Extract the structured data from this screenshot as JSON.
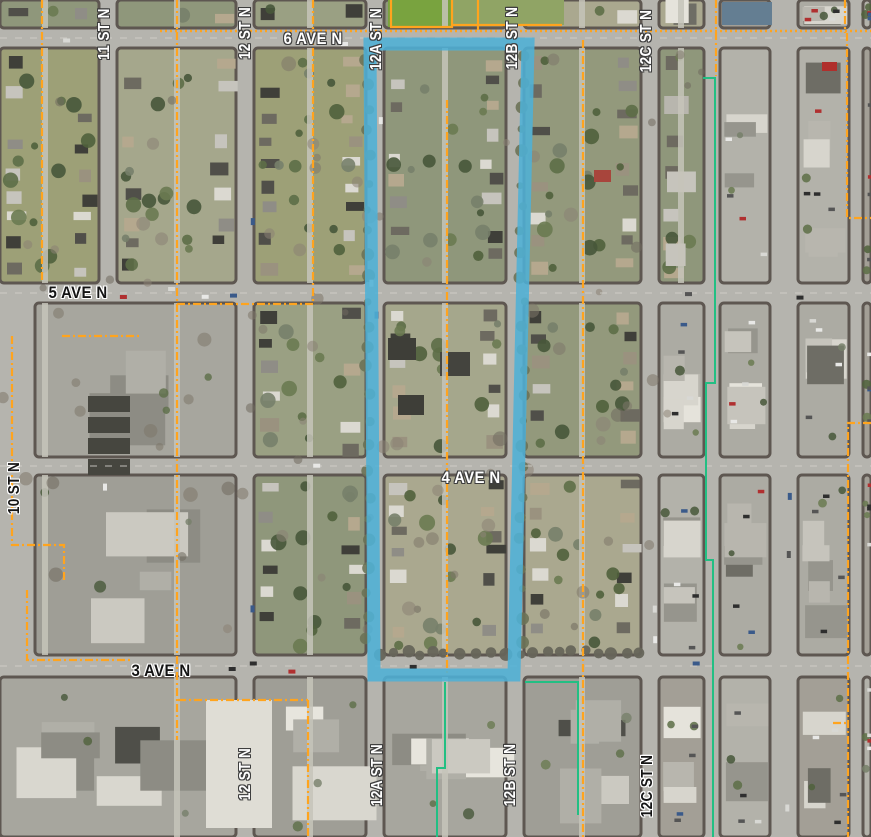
{
  "map": {
    "description": "aerial-orthophoto-with-street-grid-overlay",
    "labels": {
      "ave6": "6 AVE N",
      "ave5": "5 AVE N",
      "ave4": "4 AVE N",
      "ave3": "3 AVE N",
      "st10": "10 ST N",
      "st11": "11 ST N",
      "st12_top": "12 ST N",
      "st12a_top": "12A ST N",
      "st12b_top": "12B ST N",
      "st12c_top": "12C ST N",
      "st12_bot": "12 ST N",
      "st12a_bot": "12A ST N",
      "st12b_bot": "12B ST N",
      "st12c_bot": "12C ST N"
    },
    "overlay_colors": {
      "selection_outline": "#4FB1D6",
      "boundary_line": "#FFA41E",
      "utility_line": "#22BF83",
      "block_outline": "#5E5751"
    }
  }
}
